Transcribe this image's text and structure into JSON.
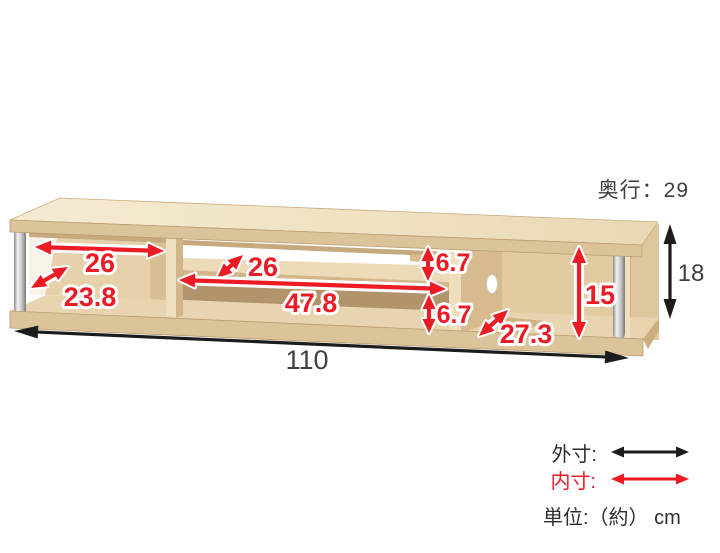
{
  "diagram": {
    "depth_note": "奥行：29",
    "outer": {
      "width": "110",
      "height": "18"
    },
    "inner": {
      "left_width": "26",
      "left_depth": "23.8",
      "shelf_depth": "26",
      "middle_width": "47.8",
      "upper_height": "6.7",
      "lower_height": "6.7",
      "right_height": "15",
      "right_depth": "27.3"
    }
  },
  "legend": {
    "outer": "外寸:",
    "inner": "内寸:",
    "unit": "単位:（約） cm"
  },
  "colors": {
    "inner_dim_red": "#ed1c24",
    "outer_dim_black": "#1c1c1c",
    "wood_light": "#f0e3c4",
    "wood_mid": "#dcc49a"
  }
}
